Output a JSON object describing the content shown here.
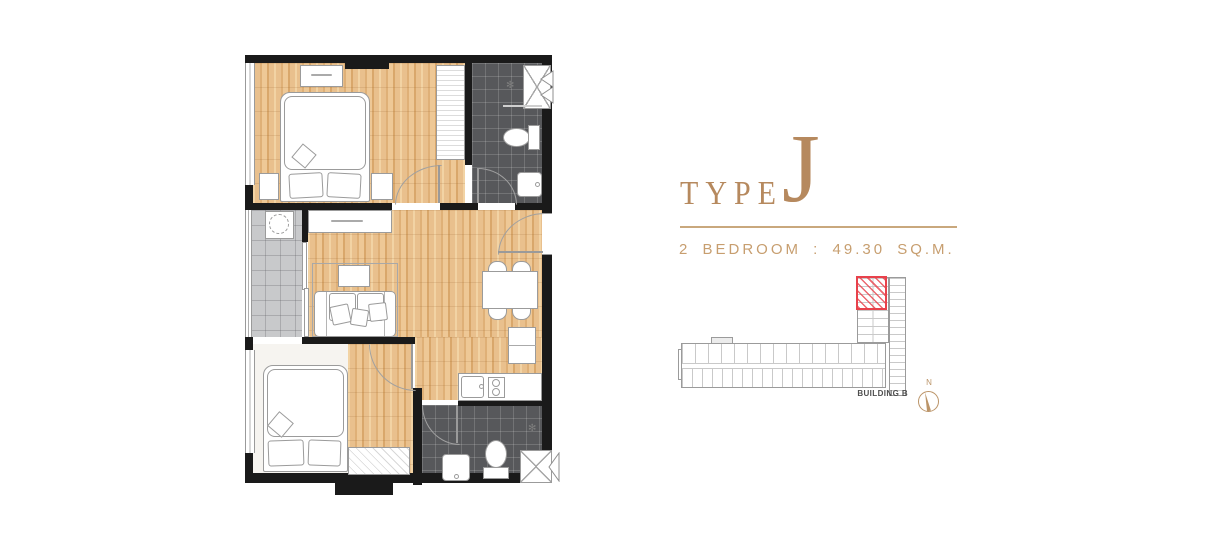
{
  "header": {
    "type_label": "TYPE",
    "type_letter": "J",
    "spec": "2 BEDROOM : 49.30 SQ.M.",
    "accent_color": "#b6895e",
    "rule_color": "#c9a87d",
    "spec_color": "#c79e6f"
  },
  "sitemap": {
    "building_label": "BUILDING B",
    "compass_letter": "N",
    "outline_color": "#9b9b9b",
    "unit_highlight_color": "#e8414b",
    "compass_color": "#bb9468"
  },
  "plan": {
    "icons": {
      "shower_head": "✻"
    },
    "colors": {
      "wall": "#1a1a1a",
      "wood_floor": "#e9c08d",
      "bathroom_tile": "#57585b",
      "balcony_tile": "#c8c9cb",
      "bedroom2_floor": "#f6f4f0",
      "furniture_line": "#9b9b9b"
    }
  }
}
